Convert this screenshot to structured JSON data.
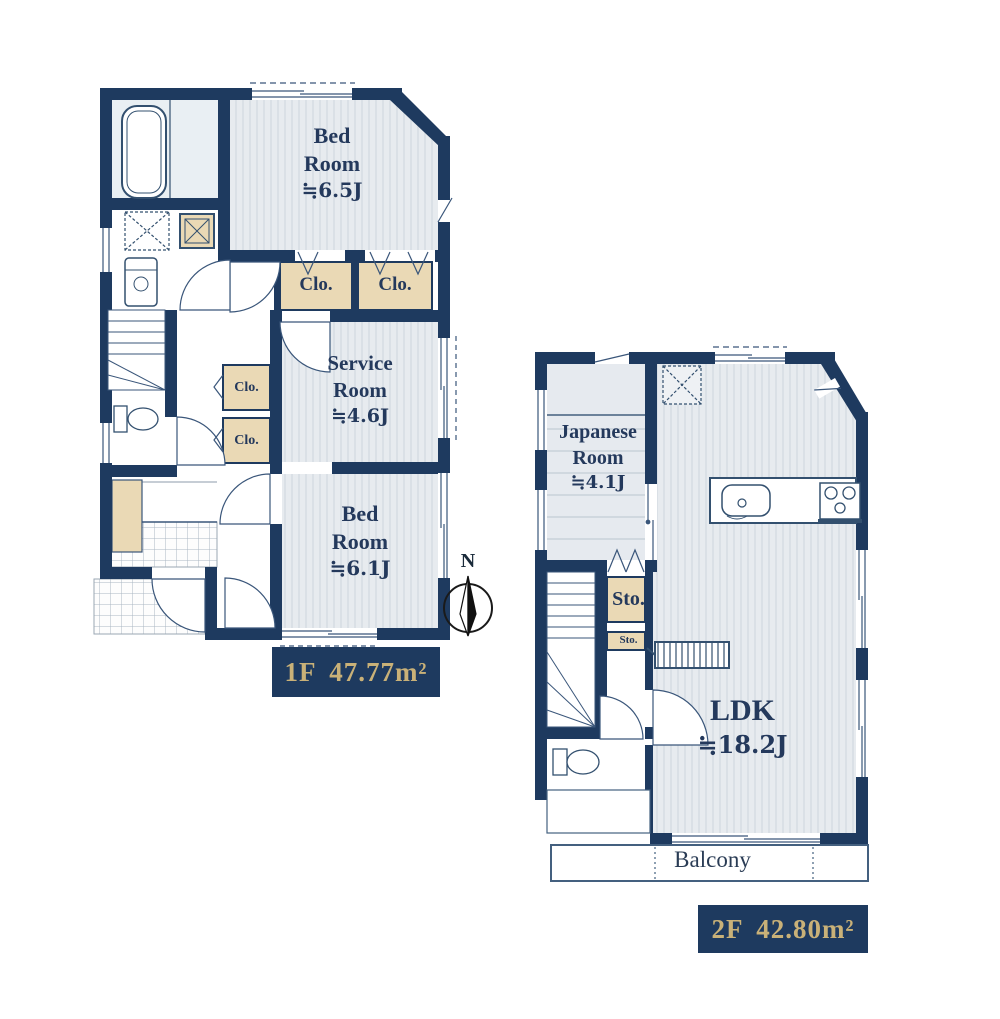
{
  "compass": {
    "north": "N"
  },
  "floor1": {
    "area_label": "1F 47.77m²",
    "rooms": {
      "bedroom_top": {
        "name": "Bed Room",
        "size": "≒6.5J"
      },
      "service_room": {
        "name": "Service Room",
        "size": "≒4.6J"
      },
      "bedroom_bottom": {
        "name": "Bed Room",
        "size": "≒6.1J"
      }
    },
    "closets": {
      "c1": "Clo.",
      "c2": "Clo.",
      "c3": "Clo.",
      "c4": "Clo."
    }
  },
  "floor2": {
    "area_label": "2F 42.80m²",
    "rooms": {
      "japanese_room": {
        "name": "Japanese Room",
        "size": "≒4.1J"
      },
      "ldk": {
        "name": "LDK",
        "size": "≒18.2J"
      }
    },
    "storages": {
      "s1": "Sto.",
      "s2": "Sto."
    },
    "balcony_label": "Balcony"
  },
  "colors": {
    "wall_navy": "#1e3a5f",
    "closet_tan": "#ead9b5",
    "label_gold": "#c9b178",
    "floor_gray": "#e7ebef"
  }
}
